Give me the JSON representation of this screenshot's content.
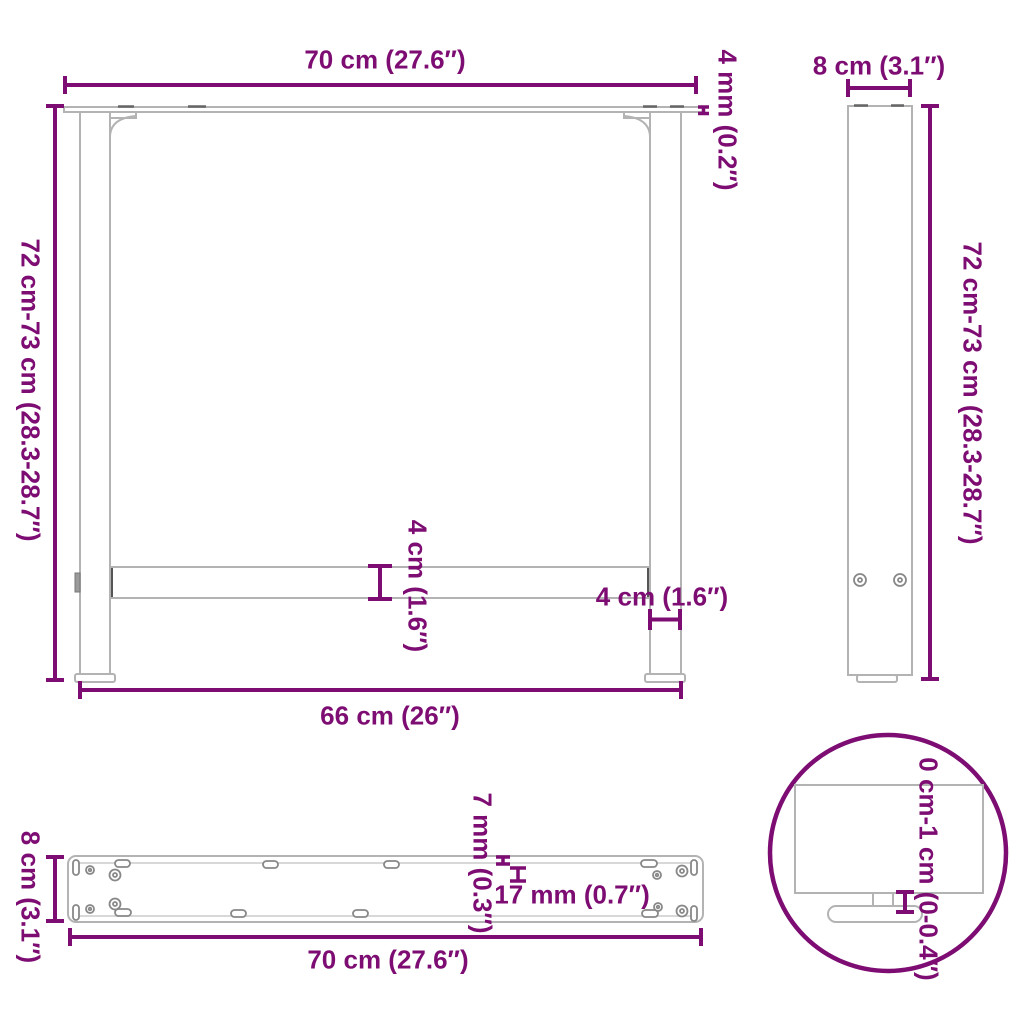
{
  "accent_color": "#7d0d72",
  "outline_color": "#b3b3b3",
  "diagram_type": "furniture-table-legs-dimension-drawing",
  "views": {
    "front": {
      "top_width": "70 cm (27.6″)",
      "plate_thickness": "4 mm (0.2″)",
      "height": "72 cm-73 cm (28.3-28.7″)",
      "crossbar_height": "4 cm (1.6″)",
      "leg_width": "4 cm (1.6″)",
      "bottom_width": "66 cm (26″)"
    },
    "side": {
      "depth": "8 cm (3.1″)",
      "height": "72 cm-73 cm (28.3-28.7″)"
    },
    "plate_top": {
      "depth": "8 cm (3.1″)",
      "hole_diameter": "7 mm (0.3″)",
      "slot_length": "17 mm (0.7″)",
      "width": "70 cm (27.6″)"
    },
    "detail": {
      "adjustable_height": "0 cm-1 cm (0-0.4″)"
    }
  }
}
